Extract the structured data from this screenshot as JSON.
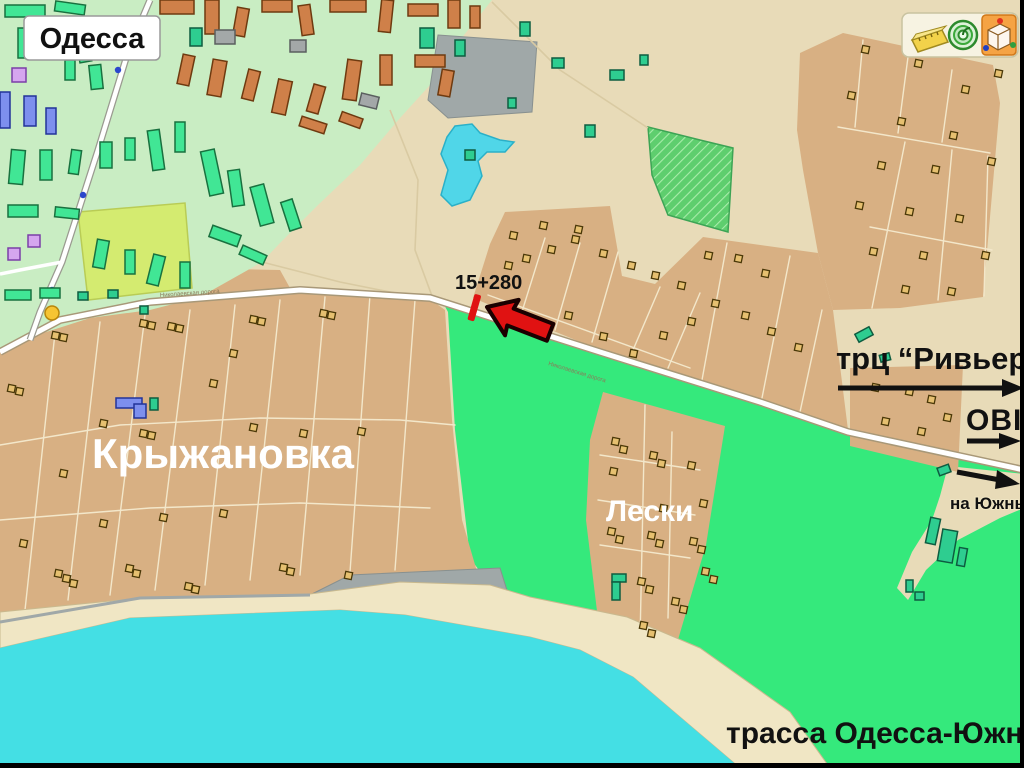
{
  "labels": {
    "city_badge": "Одесса",
    "district_main": "Крыжановка",
    "district_small": "Лески",
    "marker_chainage": "15+280",
    "mall": "трц “Ривьера”",
    "store": "OBI",
    "direction_port": "на Южный",
    "highway_caption": "трасса Одесса-Южный",
    "road_name": "Николаевская дорога"
  },
  "toolbar": {
    "icons": [
      {
        "name": "ruler-icon"
      },
      {
        "name": "target-icon"
      },
      {
        "name": "cube-3d-icon"
      }
    ]
  },
  "colors": {
    "base": "#e8dbb8",
    "tan": "#d8b083",
    "cityGreen": "#c9edc3",
    "brightGreen": "#35e97c",
    "hatchGreen": "#5ece6e",
    "hatchLine": "#a8ecaa",
    "sea": "#44dfe4",
    "lake": "#50d6e8",
    "beach": "#f0e6c4",
    "grayArea": "#a0a8a8",
    "field": "#d4eb70",
    "roadFill": "#ffffff",
    "roadCase": "#a89878",
    "bldgGreen": "#41e695",
    "bldgOrange": "#cf8049",
    "bldgTeal": "#2ecd90",
    "bldgGray": "#a3a8a8",
    "bldgPurple": "#d5a6ef",
    "bldgBlue": "#7d8fee",
    "markerRed": "#e01212",
    "arrowBlack": "#111111"
  }
}
